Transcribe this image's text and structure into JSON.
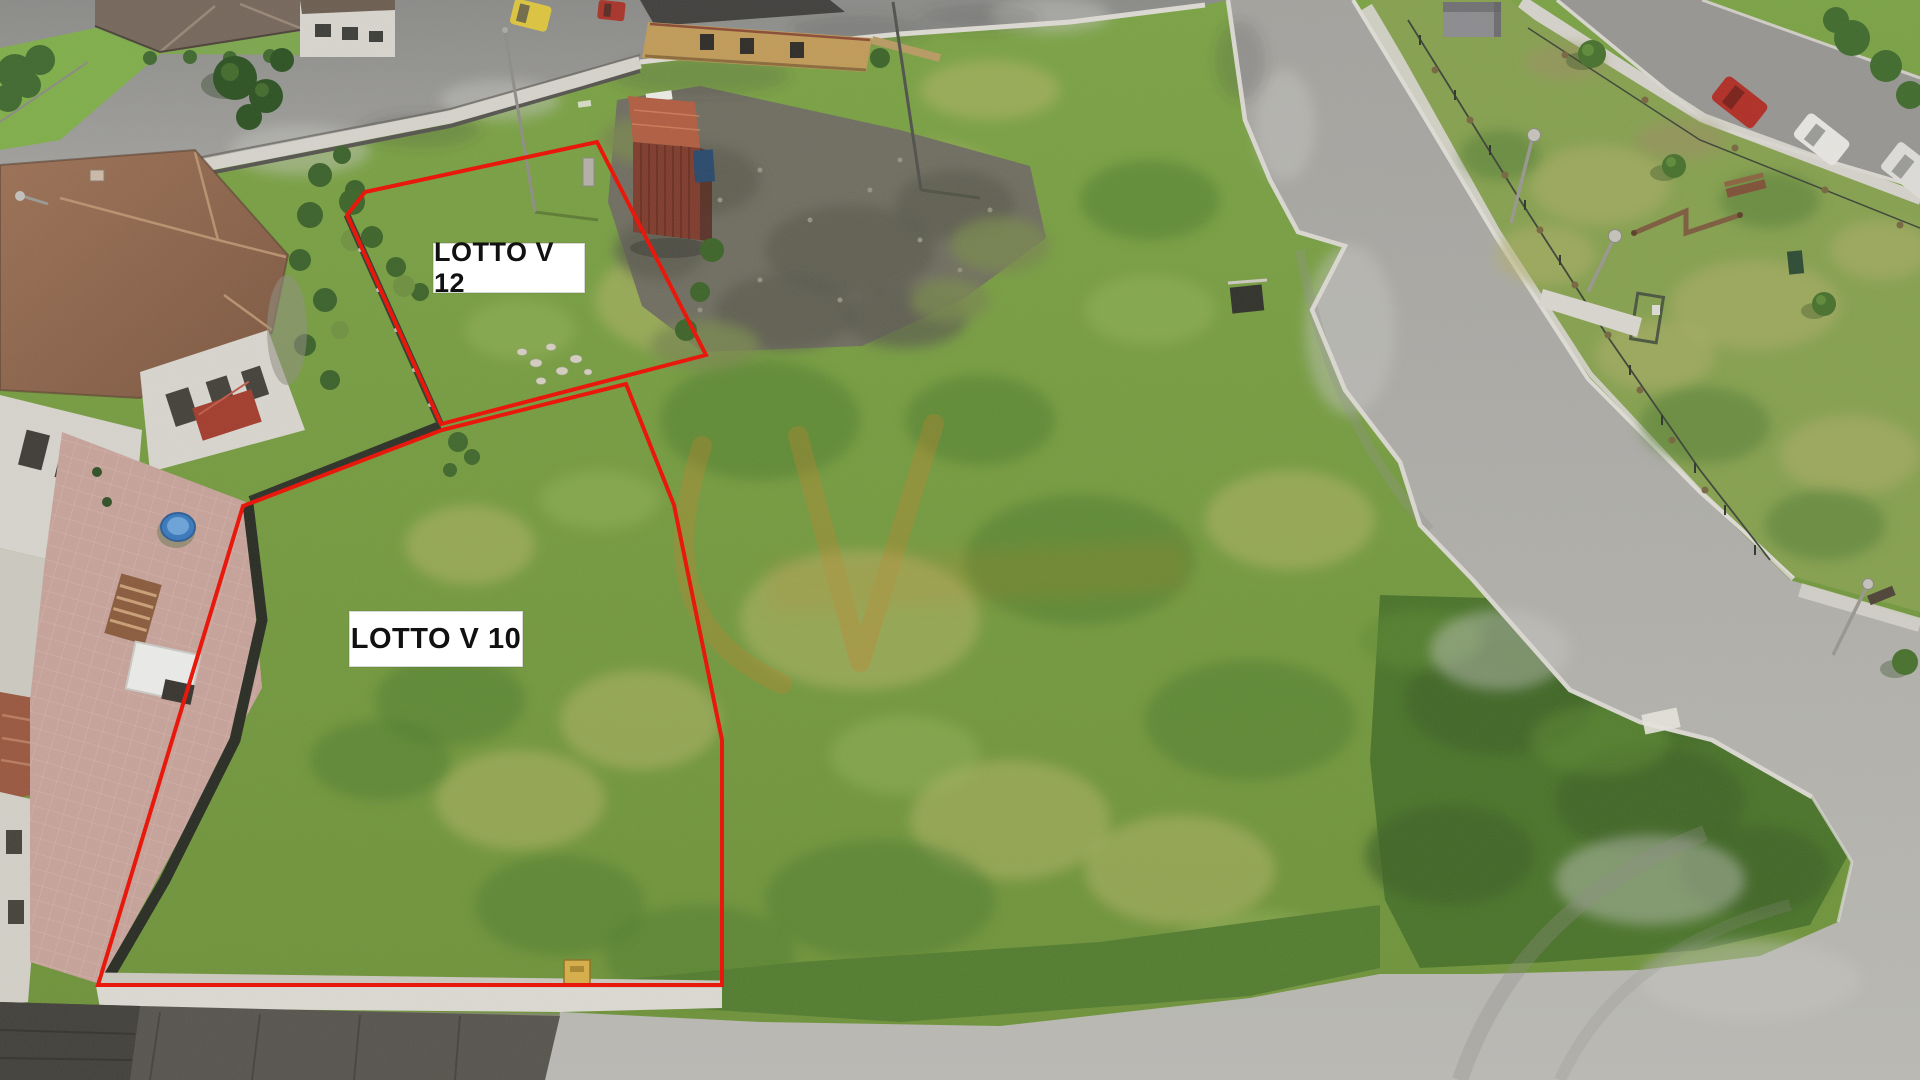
{
  "annotations": {
    "boundary_color": "#e8190c",
    "lots": [
      {
        "id": "v12",
        "label": "LOTTO V 12"
      },
      {
        "id": "v10",
        "label": "LOTTO V 10"
      }
    ],
    "label_style": {
      "background": "#ffffff",
      "text_color": "#111111"
    }
  },
  "watermark": {
    "color": "#c9822e",
    "opacity": "0.3"
  }
}
